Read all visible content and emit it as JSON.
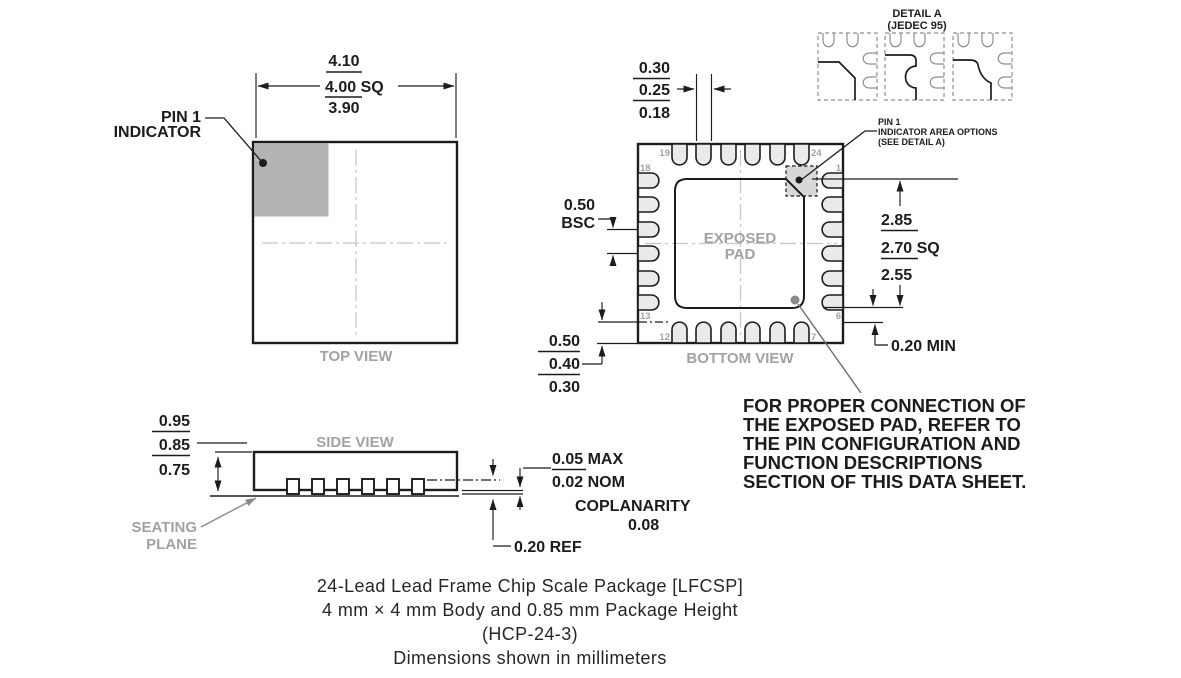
{
  "top_view": {
    "label": "TOP VIEW",
    "body_dim": {
      "max": "4.10",
      "nom": "4.00 SQ",
      "min": "3.90"
    },
    "pin1_callout": {
      "line1": "PIN 1",
      "line2": "INDICATOR"
    }
  },
  "bottom_view": {
    "label": "BOTTOM VIEW",
    "exposed_pad": {
      "line1": "EXPOSED",
      "line2": "PAD"
    },
    "pin_numbers": {
      "p19": "19",
      "p24": "24",
      "p18": "18",
      "p1": "1",
      "p13": "13",
      "p6": "6",
      "p12": "12",
      "p7": "7"
    },
    "lead_width_dim": {
      "max": "0.30",
      "nom": "0.25",
      "min": "0.18"
    },
    "pitch_dim": {
      "value": "0.50",
      "suffix": "BSC"
    },
    "lead_length_dim": {
      "max": "0.50",
      "nom": "0.40",
      "min": "0.30"
    },
    "pad_dim": {
      "max": "2.85",
      "nom": "2.70 SQ",
      "min": "2.55"
    },
    "pad_clearance": "0.20 MIN",
    "pin1_area_note": {
      "line1": "PIN 1",
      "line2": "INDICATOR AREA OPTIONS",
      "line3": "(SEE DETAIL A)"
    }
  },
  "detail_a": {
    "title": "DETAIL A",
    "subtitle": "(JEDEC 95)"
  },
  "side_view": {
    "label": "SIDE VIEW",
    "height_dim": {
      "max": "0.95",
      "nom": "0.85",
      "min": "0.75"
    },
    "seating_plane": {
      "line1": "SEATING",
      "line2": "PLANE"
    },
    "standoff_dim": {
      "line1": "0.05 MAX",
      "line2": "0.02 NOM"
    },
    "coplanarity": {
      "label": "COPLANARITY",
      "value": "0.08"
    },
    "lead_thickness": "0.20 REF"
  },
  "note": {
    "line1": "FOR PROPER CONNECTION OF",
    "line2": "THE EXPOSED PAD, REFER TO",
    "line3": "THE PIN CONFIGURATION AND",
    "line4": "FUNCTION DESCRIPTIONS",
    "line5": "SECTION OF THIS DATA SHEET."
  },
  "caption": {
    "line1": "24-Lead Lead Frame Chip Scale Package [LFCSP]",
    "line2": "4 mm × 4 mm Body and 0.85 mm Package Height",
    "line3": "(HCP-24-3)",
    "line4": "Dimensions shown in millimeters"
  },
  "colors": {
    "line": "#1c1c1c",
    "gray_text": "#a2a2a2",
    "pin_fill": "#eaeaea",
    "indicator_fill": "#b4b4b4",
    "indicator_area_fill": "#d8d8d8"
  }
}
